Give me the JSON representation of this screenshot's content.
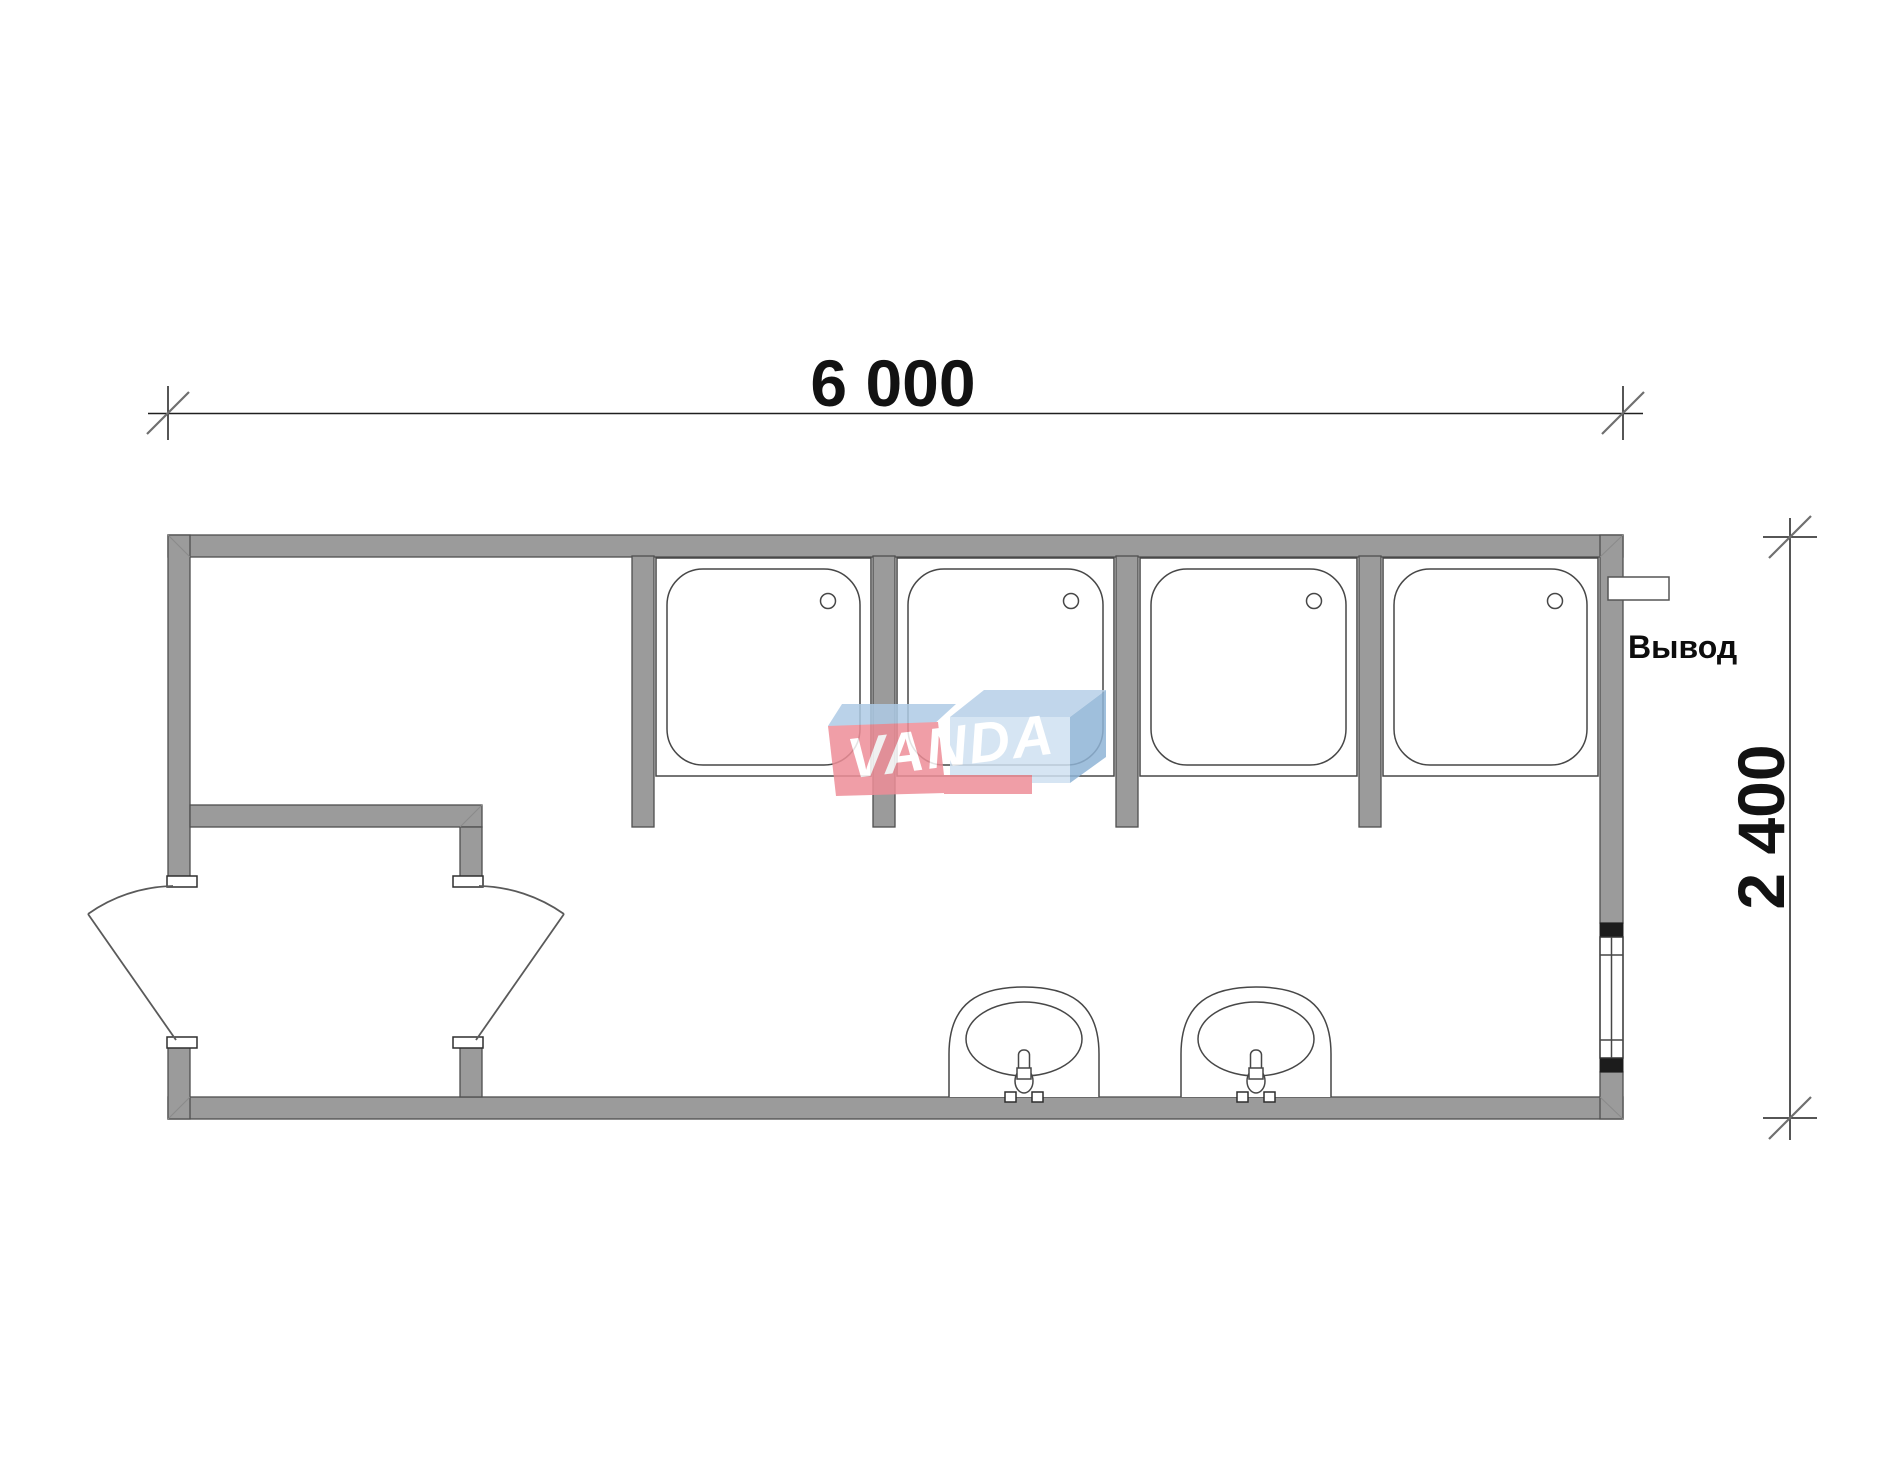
{
  "drawing": {
    "type": "floor-plan",
    "description": "Plan of a 6000x2400 modular cabin with 4 shower trays, 2 washbasins, entry vestibule with two door leaves, window and utility outlet"
  },
  "dimensions": {
    "length_label": "6 000",
    "depth_label": "2 400"
  },
  "annotations": {
    "outlet_label": "Вывод"
  },
  "watermark": {
    "text": "VANDA",
    "colors": {
      "red": "#ee8e98",
      "blue_flap": "#b7d0e8",
      "blue_flap_light": "#aecbe6",
      "blue_front": "#cfe1f1",
      "blue_side": "#8fb4d6",
      "letters": "#ffffff"
    }
  },
  "colors": {
    "wall_fill": "#9b9b9b",
    "wall_stroke": "#4f4f4f",
    "line": "#474747",
    "dim_line": "#1f1f1f",
    "background": "#ffffff"
  },
  "fixtures": {
    "shower_trays": 4,
    "washbasins": 2,
    "door_leaves": 2,
    "windows": 1,
    "outlets": 1
  }
}
